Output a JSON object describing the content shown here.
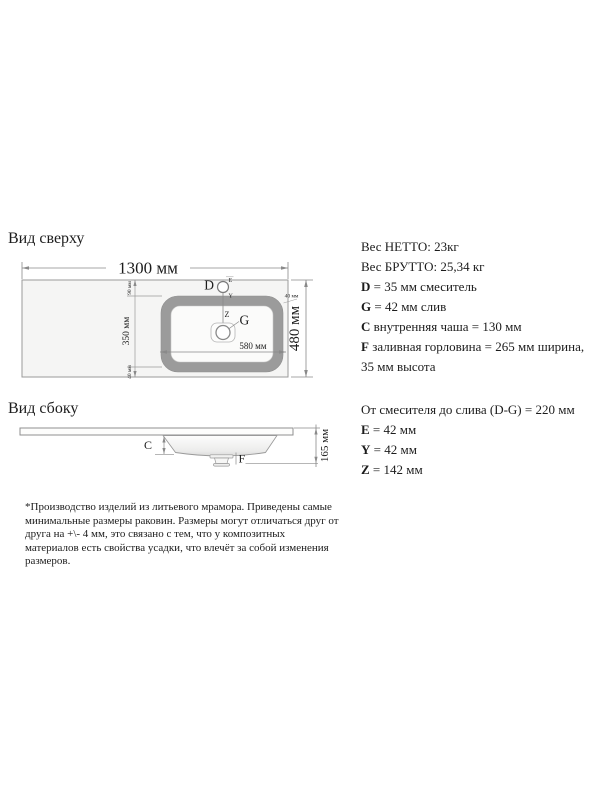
{
  "top_view": {
    "heading": "Вид сверху",
    "labels": {
      "width": "1300 мм",
      "height": "480 мм",
      "basin_width": "580 мм",
      "basin_height": "350 мм",
      "offset_top": "90 мм",
      "offset_bottom": "40 мм",
      "offset_right": "40 мм",
      "d": "D",
      "e": "E",
      "y": "Y",
      "z": "Z",
      "g": "G"
    }
  },
  "side_view": {
    "heading": "Вид сбоку",
    "labels": {
      "height": "165 мм",
      "c": "C",
      "f": "F"
    }
  },
  "specs_upper": {
    "rows": [
      {
        "bold": "",
        "rest": "Вес НЕТТО: 23кг"
      },
      {
        "bold": "",
        "rest": "Вес БРУТТО: 25,34 кг"
      },
      {
        "bold": "D",
        "rest": " = 35 мм смеситель"
      },
      {
        "bold": "G",
        "rest": " = 42 мм слив"
      },
      {
        "bold": "C",
        "rest": " внутренняя чаша = 130 мм"
      },
      {
        "bold": "F",
        "rest": " заливная горловина = 265 мм ширина,"
      },
      {
        "bold": "",
        "rest": "35 мм высота"
      }
    ]
  },
  "specs_lower": {
    "rows": [
      {
        "bold": "",
        "rest": "От смесителя до слива (D-G) = 220 мм"
      },
      {
        "bold": "E",
        "rest": " = 42 мм"
      },
      {
        "bold": "Y",
        "rest": " = 42 мм"
      },
      {
        "bold": "Z",
        "rest": " = 142 мм"
      }
    ]
  },
  "footnote": {
    "lines": [
      "*Производство изделий из литьевого мрамора. Приведены самые",
      "минимальные размеры раковин. Размеры могут отличаться друг от",
      "друга на +\\- 4 мм, это связано с тем, что у композитных",
      "материалов есть свойства усадки, что влечёт за собой изменения",
      "размеров."
    ]
  },
  "colors": {
    "line": "#8a8a8a",
    "basin_ring": "#9b9b9b",
    "countertop_fill": "#f5f5f4"
  }
}
